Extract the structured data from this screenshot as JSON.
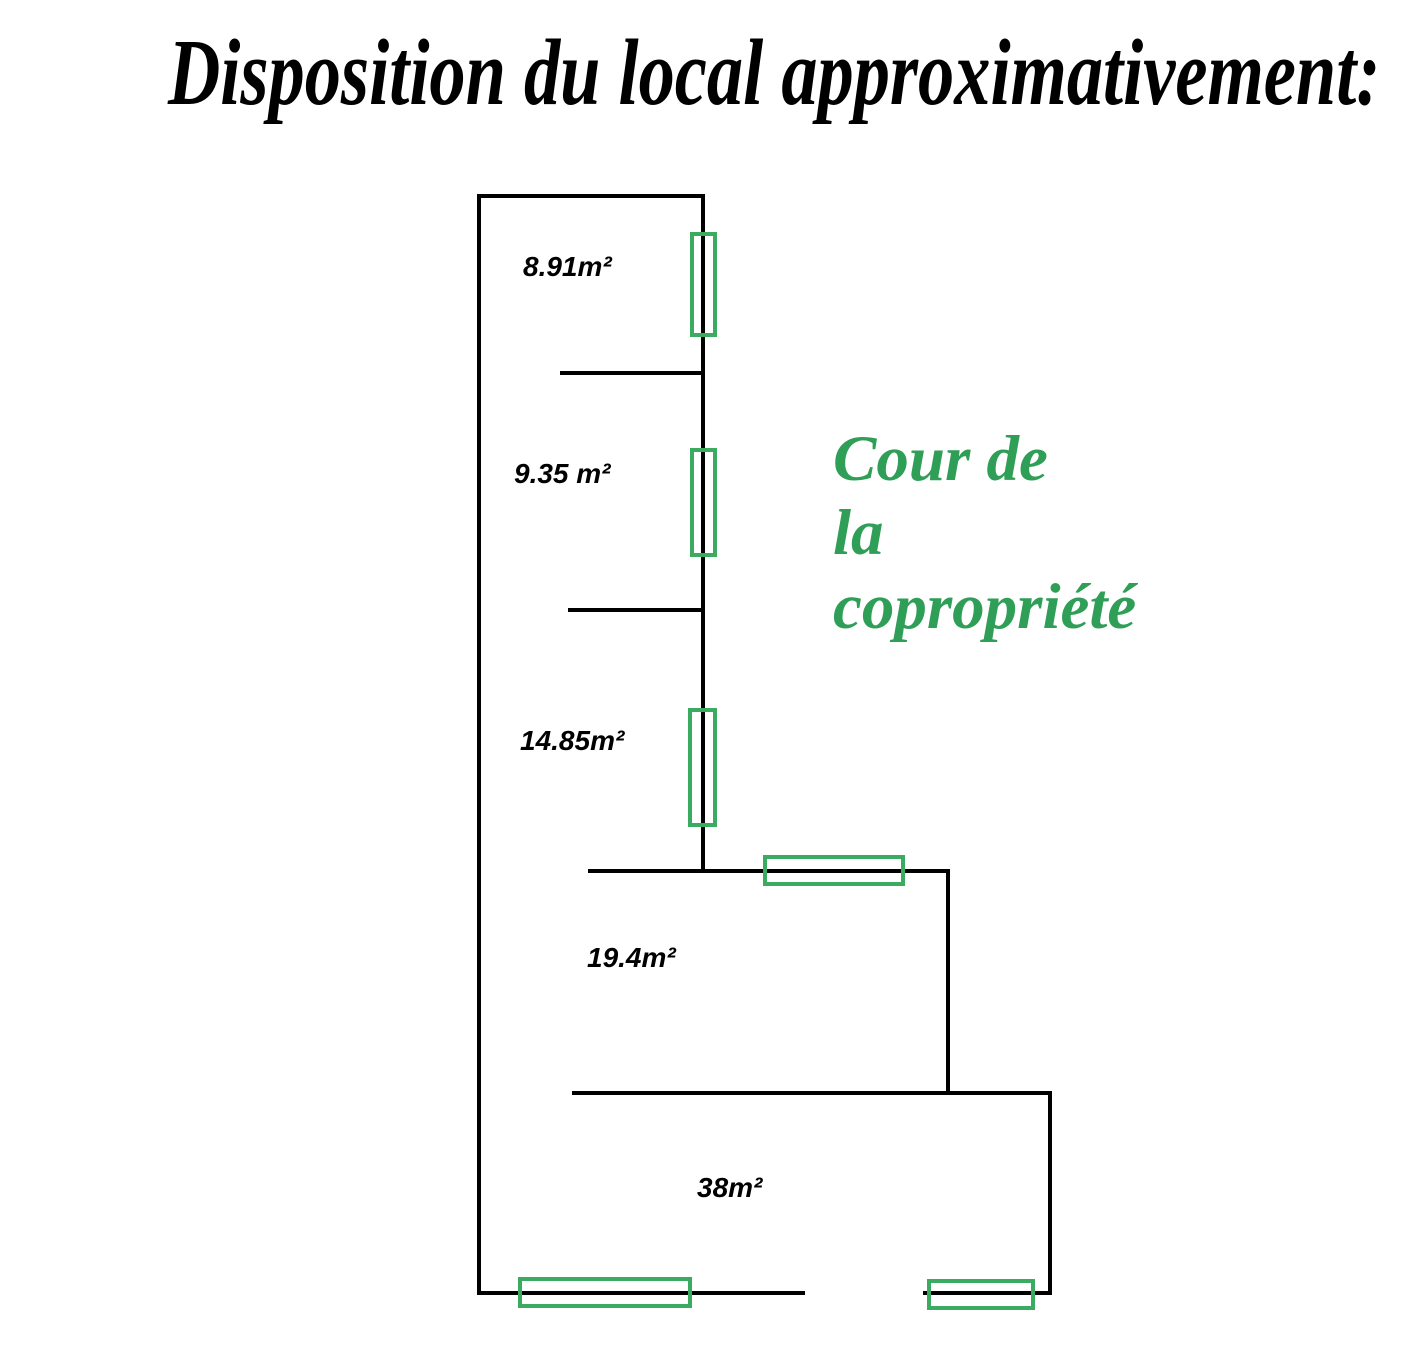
{
  "title": "Disposition du local approximativement:",
  "courtyard": {
    "lines": [
      "Cour de",
      "la",
      "copropriété"
    ]
  },
  "rooms": [
    {
      "name": "room-label-8-91",
      "label": "8.91m²",
      "x": 523,
      "y": 253
    },
    {
      "name": "room-label-9-35",
      "label": "9.35 m²",
      "x": 514,
      "y": 460
    },
    {
      "name": "room-label-14-85",
      "label": "14.85m²",
      "x": 520,
      "y": 727
    },
    {
      "name": "room-label-19-4",
      "label": "19.4m²",
      "x": 587,
      "y": 944
    },
    {
      "name": "room-label-38",
      "label": "38m²",
      "x": 697,
      "y": 1174
    }
  ],
  "plan": {
    "walls": [
      {
        "name": "wall-top",
        "x": 477,
        "y": 194,
        "w": 228,
        "h": 4
      },
      {
        "name": "wall-left",
        "x": 477,
        "y": 194,
        "w": 4,
        "h": 1101
      },
      {
        "name": "wall-right-strip",
        "x": 701,
        "y": 194,
        "w": 4,
        "h": 679
      },
      {
        "name": "wall-divider-1",
        "x": 560,
        "y": 371,
        "w": 145,
        "h": 4
      },
      {
        "name": "wall-divider-2",
        "x": 568,
        "y": 608,
        "w": 137,
        "h": 4
      },
      {
        "name": "wall-room19-top",
        "x": 588,
        "y": 869,
        "w": 362,
        "h": 4
      },
      {
        "name": "wall-room19-right",
        "x": 946,
        "y": 869,
        "w": 4,
        "h": 226
      },
      {
        "name": "wall-room38-top",
        "x": 572,
        "y": 1091,
        "w": 480,
        "h": 4
      },
      {
        "name": "wall-room38-right",
        "x": 1048,
        "y": 1091,
        "w": 4,
        "h": 204
      },
      {
        "name": "wall-bottom-left-segment",
        "x": 477,
        "y": 1291,
        "w": 328,
        "h": 4
      },
      {
        "name": "wall-bottom-right-segment",
        "x": 923,
        "y": 1291,
        "w": 129,
        "h": 4
      }
    ],
    "windows": [
      {
        "name": "window-room-8-91",
        "x": 690,
        "y": 232,
        "w": 27,
        "h": 105
      },
      {
        "name": "window-room-9-35",
        "x": 690,
        "y": 448,
        "w": 27,
        "h": 109
      },
      {
        "name": "window-room-14-85",
        "x": 688,
        "y": 708,
        "w": 29,
        "h": 119
      },
      {
        "name": "window-room-19-4",
        "x": 763,
        "y": 855,
        "w": 142,
        "h": 31
      },
      {
        "name": "window-room-38-left",
        "x": 518,
        "y": 1277,
        "w": 174,
        "h": 31
      },
      {
        "name": "window-room-38-right",
        "x": 927,
        "y": 1279,
        "w": 108,
        "h": 31
      }
    ]
  },
  "colors": {
    "wall": "#000000",
    "window_stroke": "#3cab62",
    "courtyard_text": "#2f9e57",
    "title_text": "#000000",
    "room_label_text": "#000000",
    "background": "#ffffff"
  }
}
